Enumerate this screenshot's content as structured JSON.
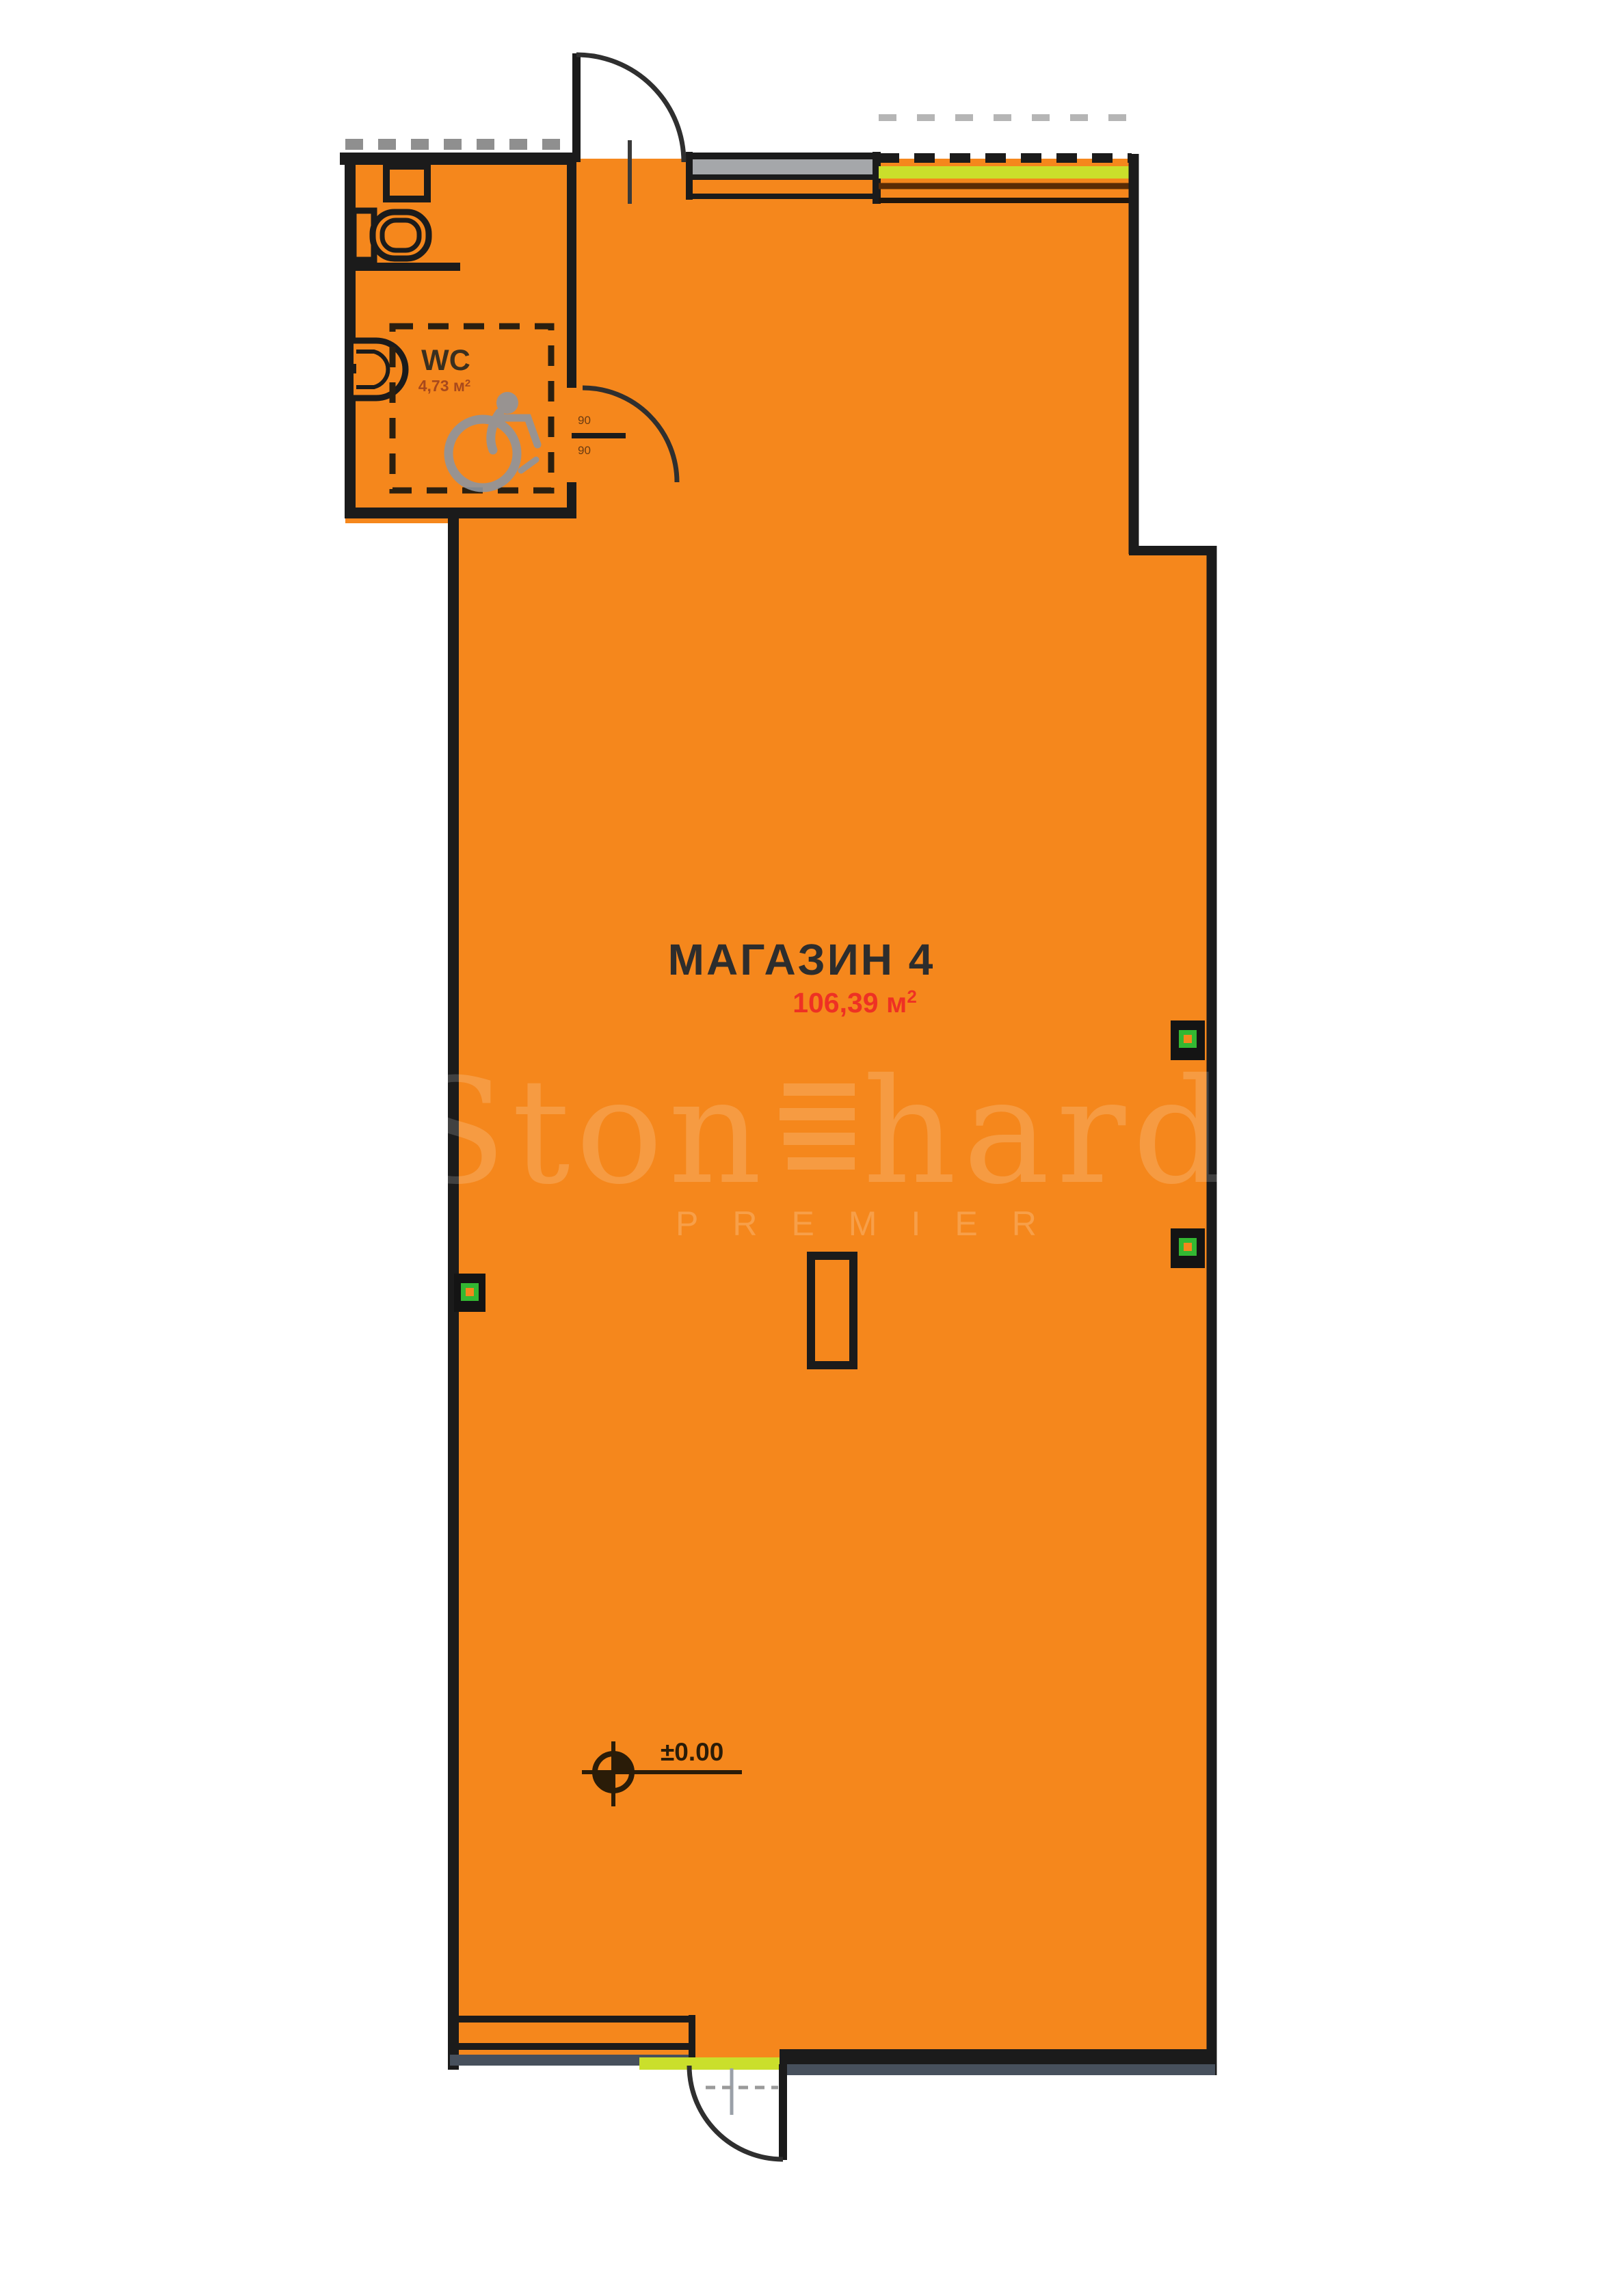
{
  "unit": {
    "name": "МАГАЗИН 4",
    "area_text": "106,39 м",
    "area_sup": "2"
  },
  "wc": {
    "name": "WC",
    "area_text": "4,73 м",
    "area_sup": "2",
    "door_dim_top": "90",
    "door_dim_bottom": "90"
  },
  "elevation": {
    "value": "±0.00"
  },
  "watermark": {
    "brand_left": "Ston",
    "brand_right": "hard",
    "tagline": "PREMIER"
  },
  "icons": {
    "wheelchair-icon": "accessible-wc-symbol",
    "toilet-icon": "wc-toilet-plan-symbol",
    "sink-icon": "washbasin-plan-symbol",
    "elevation-marker-icon": "level-datum-crosshair",
    "outlet-icon": "electrical-socket-marker"
  },
  "colors": {
    "floor": "#F5871C",
    "wall": "#1B1B1B",
    "lime": "#CADF2B",
    "glass": "#A5A7AA",
    "plinth": "#47505C",
    "outlet_green": "#33B832",
    "area_red": "#EE3124"
  }
}
